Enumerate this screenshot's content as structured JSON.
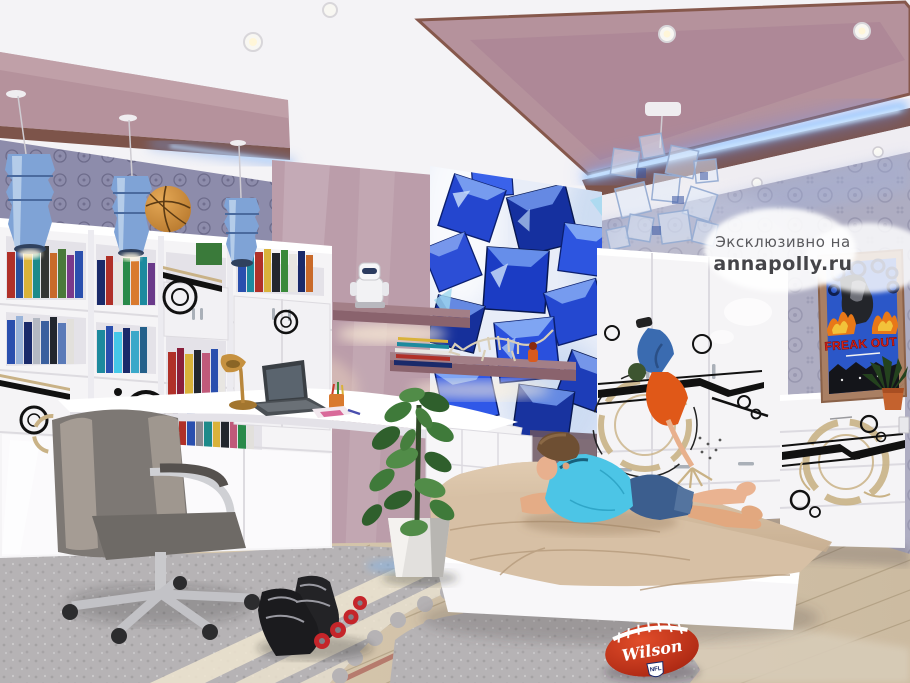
{
  "watermark": {
    "prefix": "Эксклюзивно на",
    "site": "annapolly.ru"
  },
  "poster": {
    "title": "FREAK OUT"
  },
  "football": {
    "brand": "Wilson",
    "badge": "NFL"
  },
  "colors": {
    "ceiling_mauve": "#b5929c",
    "trim_brown": "#7d544a",
    "led_blue": "#8fc6ff",
    "wall_lavender": "#aeadc2",
    "wall_mauve_panel": "#bb9daa",
    "mural_blue": "#1b3cc4",
    "furniture_white": "#f5f4f6",
    "blanket_beige": "#d7c0a5",
    "shirt_cyan": "#4cc5e6",
    "jeans_blue": "#3c5e8e",
    "floor_wood": "#d3c4ab",
    "rug_gray": "#b6b3b5",
    "football_red": "#c62c18",
    "poster_red": "#e02018",
    "pendant_blue": "#7fa3d6",
    "basketball_orange": "#d4913e"
  }
}
